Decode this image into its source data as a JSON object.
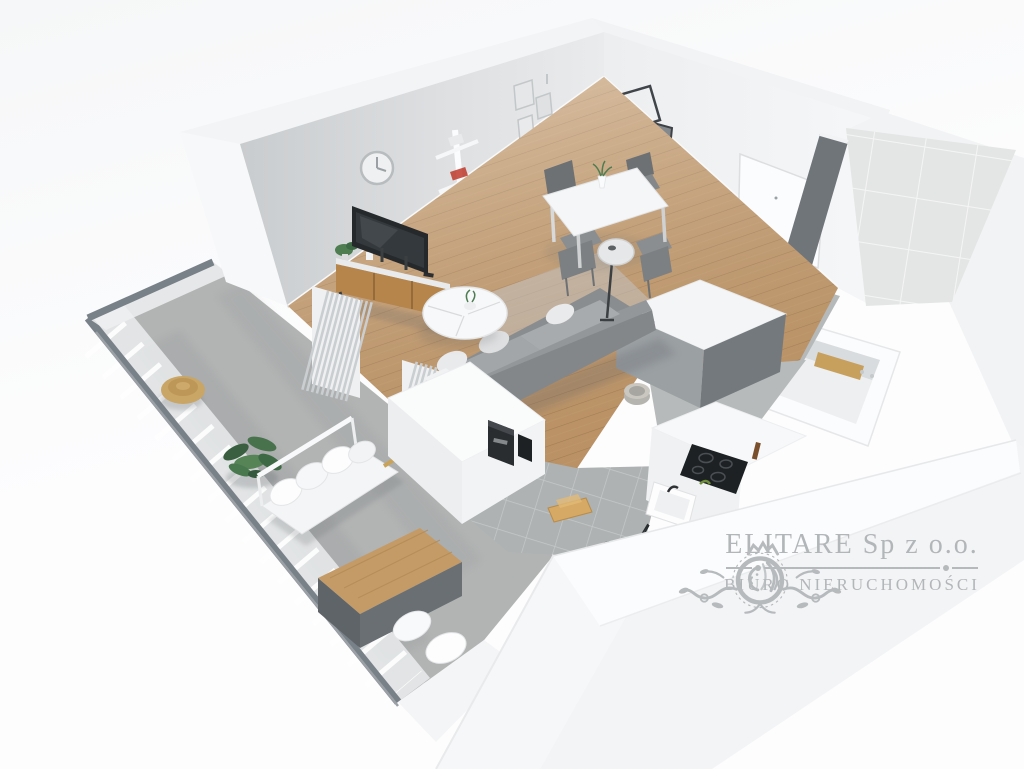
{
  "watermark": {
    "company": "ELITARE Sp z o.o.",
    "subtitle": "BIURO NIERUCHOMOŚCI",
    "emblem": "lion-crest",
    "color": "#b3b6b9"
  },
  "scene": {
    "description": "3D isometric render of a studio apartment floor plan",
    "rooms": [
      "living-room",
      "dining-area",
      "kitchen",
      "hallway",
      "bathroom",
      "balcony"
    ],
    "furniture": [
      "wall-clock",
      "tv",
      "tv-console",
      "zigzag-bookshelf",
      "picture-frames",
      "wire-frame",
      "wall-mirror",
      "dining-table",
      "dining-chairs",
      "vase-with-flowers",
      "floor-lamp",
      "sofa",
      "coffee-table",
      "curtains",
      "kitchen-island",
      "coffee-machine",
      "cooktop",
      "kitchen-sink",
      "cutting-board",
      "fruit-bowl",
      "kettle",
      "pepper-grinder",
      "entrance-door",
      "bathtub",
      "bath-caddy",
      "tile-wall",
      "laundry-basket",
      "balcony-bench",
      "bench-pillows",
      "balcony-low-table",
      "floor-cushions",
      "potted-plant",
      "wicker-pouf",
      "glass-railing"
    ],
    "palette": {
      "background": "#fbfcfd",
      "wall_light": "#eef0f1",
      "wall_gray": "#d3d6d8",
      "wall_dark": "#70757a",
      "floor_wood": "#c49a6c",
      "floor_concrete": "#b3b6b6",
      "tile": "#e1e3e2",
      "sofa_gray": "#8a8e90",
      "accent_wood": "#c8a05e",
      "plant_green": "#4e7d52",
      "gold": "#b08d3f"
    }
  }
}
